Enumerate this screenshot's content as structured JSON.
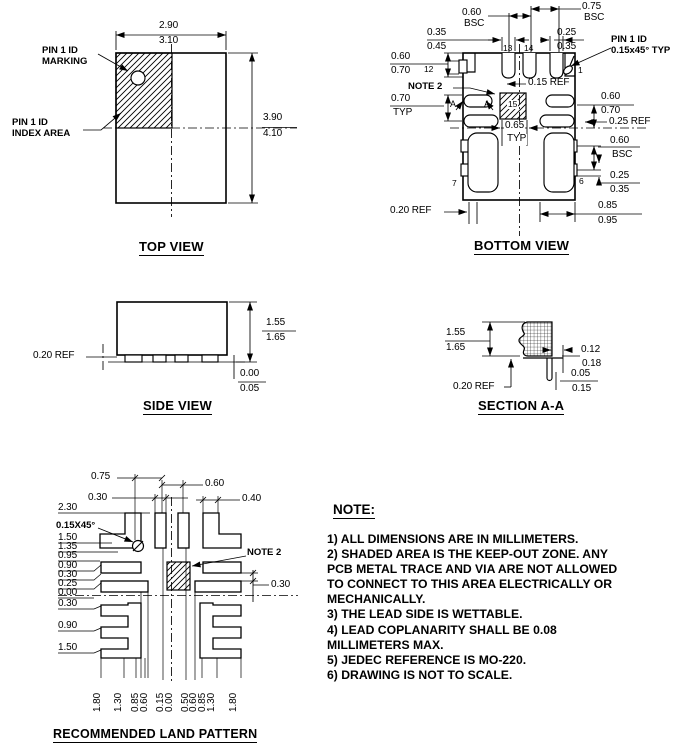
{
  "page": {
    "bg": "#ffffff",
    "ink": "#000000"
  },
  "views": {
    "top_view": {
      "title": "TOP VIEW",
      "labels": [
        {
          "n": "dim-body-width-min",
          "t": "2.90",
          "x": 159,
          "y": 21
        },
        {
          "n": "dim-body-width-max",
          "t": "3.10",
          "x": 159,
          "y": 36
        },
        {
          "n": "dim-body-height-min",
          "t": "3.90",
          "x": 263,
          "y": 113
        },
        {
          "n": "dim-body-height-max",
          "t": "4.10",
          "x": 263,
          "y": 129
        },
        {
          "n": "pin1-marking-label-line1",
          "t": "PIN 1 ID",
          "x": 42,
          "y": 46,
          "b": 1
        },
        {
          "n": "pin1-marking-label-line2",
          "t": "MARKING",
          "x": 42,
          "y": 57,
          "b": 1
        },
        {
          "n": "pin1-index-label-line1",
          "t": "PIN 1 ID",
          "x": 12,
          "y": 118,
          "b": 1
        },
        {
          "n": "pin1-index-label-line2",
          "t": "INDEX AREA",
          "x": 12,
          "y": 129,
          "b": 1
        }
      ]
    },
    "bottom_view": {
      "title": "BOTTOM VIEW",
      "labels": [
        {
          "n": "dim-060-bsc-top-val",
          "t": "0.60",
          "x": 462,
          "y": 8
        },
        {
          "n": "dim-060-bsc-top-unit",
          "t": "BSC",
          "x": 464,
          "y": 19
        },
        {
          "n": "dim-075-bsc-val",
          "t": "0.75",
          "x": 582,
          "y": 2
        },
        {
          "n": "dim-075-bsc-unit",
          "t": "BSC",
          "x": 584,
          "y": 13
        },
        {
          "n": "dim-slot-width-min",
          "t": "0.35",
          "x": 427,
          "y": 28
        },
        {
          "n": "dim-slot-width-max",
          "t": "0.45",
          "x": 427,
          "y": 42
        },
        {
          "n": "dim-pin1-slot-min",
          "t": "0.25",
          "x": 557,
          "y": 28
        },
        {
          "n": "dim-pin1-slot-max",
          "t": "0.35",
          "x": 557,
          "y": 42
        },
        {
          "n": "pin1-id-label-line1",
          "t": "PIN 1 ID",
          "x": 611,
          "y": 35,
          "b": 1
        },
        {
          "n": "pin1-id-label-line2",
          "t": "0.15x45° TYP",
          "x": 611,
          "y": 46,
          "b": 1
        },
        {
          "n": "dim-lead-left-min",
          "t": "0.60",
          "x": 391,
          "y": 52
        },
        {
          "n": "dim-lead-left-max",
          "t": "0.70",
          "x": 391,
          "y": 66
        },
        {
          "n": "pin-12-label",
          "t": "12",
          "x": 424,
          "y": 65,
          "s": 8.5
        },
        {
          "n": "note2-callout",
          "t": "NOTE 2",
          "x": 408,
          "y": 82,
          "b": 1
        },
        {
          "n": "dim-pitch-left-val",
          "t": "0.70",
          "x": 391,
          "y": 94
        },
        {
          "n": "dim-pitch-left-typ",
          "t": "TYP",
          "x": 393,
          "y": 108
        },
        {
          "n": "section-arrow-a-left",
          "t": "A",
          "x": 450,
          "y": 100,
          "s": 9
        },
        {
          "n": "section-arrow-a-right",
          "t": "A",
          "x": 484,
          "y": 100,
          "s": 9
        },
        {
          "n": "dim-015-ref",
          "t": "0.15 REF",
          "x": 528,
          "y": 78
        },
        {
          "n": "pin-13-label",
          "t": "13",
          "x": 503,
          "y": 44,
          "s": 8.5
        },
        {
          "n": "pin-14-label",
          "t": "14",
          "x": 524,
          "y": 44,
          "s": 8.5
        },
        {
          "n": "pin-1-label",
          "t": "1",
          "x": 578,
          "y": 66,
          "s": 8.5
        },
        {
          "n": "pin-15-label",
          "t": "15",
          "x": 507,
          "y": 100,
          "s": 8.5,
          "bg": 1
        },
        {
          "n": "dim-lead-right-min",
          "t": "0.60",
          "x": 601,
          "y": 92
        },
        {
          "n": "dim-lead-right-max",
          "t": "0.70",
          "x": 601,
          "y": 106
        },
        {
          "n": "dim-025-ref-right",
          "t": "0.25 REF",
          "x": 609,
          "y": 117
        },
        {
          "n": "dim-065-typ-val",
          "t": "0.65",
          "x": 504,
          "y": 121,
          "bg": 1
        },
        {
          "n": "dim-065-typ-unit",
          "t": "TYP",
          "x": 506,
          "y": 134,
          "bg": 1
        },
        {
          "n": "dim-060-bsc-right-val",
          "t": "0.60",
          "x": 610,
          "y": 136
        },
        {
          "n": "dim-060-bsc-right-unit",
          "t": "BSC",
          "x": 612,
          "y": 150
        },
        {
          "n": "dim-notch-height-min",
          "t": "0.25",
          "x": 610,
          "y": 171
        },
        {
          "n": "dim-notch-height-max",
          "t": "0.35",
          "x": 610,
          "y": 185
        },
        {
          "n": "dim-corner-pad-min",
          "t": "0.85",
          "x": 598,
          "y": 201
        },
        {
          "n": "dim-corner-pad-max",
          "t": "0.95",
          "x": 598,
          "y": 216
        },
        {
          "n": "pin-7-label",
          "t": "7",
          "x": 452,
          "y": 179,
          "s": 8.5
        },
        {
          "n": "pin-6-label",
          "t": "6",
          "x": 579,
          "y": 177,
          "s": 8.5
        },
        {
          "n": "dim-020-ref-bottom",
          "t": "0.20 REF",
          "x": 390,
          "y": 206
        }
      ]
    },
    "side_view": {
      "title": "SIDE VIEW",
      "labels": [
        {
          "n": "dim-020-ref",
          "t": "0.20 REF",
          "x": 33,
          "y": 351
        },
        {
          "n": "dim-height-min",
          "t": "1.55",
          "x": 266,
          "y": 318
        },
        {
          "n": "dim-height-max",
          "t": "1.65",
          "x": 266,
          "y": 333
        },
        {
          "n": "dim-standoff-min",
          "t": "0.00",
          "x": 240,
          "y": 369
        },
        {
          "n": "dim-standoff-max",
          "t": "0.05",
          "x": 240,
          "y": 384
        }
      ]
    },
    "section_aa": {
      "title": "SECTION A-A",
      "labels": [
        {
          "n": "dim-height-min",
          "t": "1.55",
          "x": 446,
          "y": 328
        },
        {
          "n": "dim-height-max",
          "t": "1.65",
          "x": 446,
          "y": 343
        },
        {
          "n": "dim-flank-min",
          "t": "0.12",
          "x": 581,
          "y": 345
        },
        {
          "n": "dim-flank-max",
          "t": "0.18",
          "x": 582,
          "y": 359
        },
        {
          "n": "dim-step-min",
          "t": "0.05",
          "x": 571,
          "y": 369
        },
        {
          "n": "dim-step-max",
          "t": "0.15",
          "x": 572,
          "y": 384
        },
        {
          "n": "dim-020-ref",
          "t": "0.20 REF",
          "x": 453,
          "y": 382
        }
      ]
    },
    "land_pattern": {
      "title": "RECOMMENDED LAND PATTERN",
      "labels": [
        {
          "n": "dim-075-top",
          "t": "0.75",
          "x": 91,
          "y": 472
        },
        {
          "n": "dim-030-top",
          "t": "0.30",
          "x": 88,
          "y": 493
        },
        {
          "n": "dim-060-top",
          "t": "0.60",
          "x": 205,
          "y": 479
        },
        {
          "n": "dim-040-top",
          "t": "0.40",
          "x": 242,
          "y": 494
        },
        {
          "n": "dim-230-left",
          "t": "2.30",
          "x": 58,
          "y": 503
        },
        {
          "n": "chamfer-callout",
          "t": "0.15X45°",
          "x": 56,
          "y": 521,
          "b": 1
        },
        {
          "n": "dim-150-upper",
          "t": "1.50",
          "x": 58,
          "y": 533
        },
        {
          "n": "dim-135-left",
          "t": "1.35",
          "x": 58,
          "y": 542
        },
        {
          "n": "dim-095-left",
          "t": "0.95",
          "x": 58,
          "y": 551
        },
        {
          "n": "dim-090-upper",
          "t": "0.90",
          "x": 58,
          "y": 561
        },
        {
          "n": "dim-030-upper",
          "t": "0.30",
          "x": 58,
          "y": 570
        },
        {
          "n": "dim-025-left",
          "t": "0.25",
          "x": 58,
          "y": 579
        },
        {
          "n": "dim-000-left",
          "t": "0.00",
          "x": 58,
          "y": 588
        },
        {
          "n": "dim-030-lower",
          "t": "0.30",
          "x": 58,
          "y": 599
        },
        {
          "n": "dim-090-lower",
          "t": "0.90",
          "x": 58,
          "y": 621
        },
        {
          "n": "dim-150-lower",
          "t": "1.50",
          "x": 58,
          "y": 643
        },
        {
          "n": "note2-callout",
          "t": "NOTE 2",
          "x": 247,
          "y": 548,
          "b": 1
        },
        {
          "n": "dim-030-right",
          "t": "0.30",
          "x": 271,
          "y": 580
        },
        {
          "n": "dim-180-bottom-left",
          "t": "1.80",
          "x": 93,
          "y": 712,
          "r": 1
        },
        {
          "n": "dim-130-bottom-left",
          "t": "1.30",
          "x": 114,
          "y": 712,
          "r": 1
        },
        {
          "n": "dim-085-bottom-left",
          "t": "0.85",
          "x": 131,
          "y": 712,
          "r": 1
        },
        {
          "n": "dim-060-bottom-left",
          "t": "0.60",
          "x": 140,
          "y": 712,
          "r": 1
        },
        {
          "n": "dim-015-bottom-left",
          "t": "0.15",
          "x": 156,
          "y": 712,
          "r": 1
        },
        {
          "n": "dim-000-bottom",
          "t": "0.00",
          "x": 165,
          "y": 712,
          "r": 1
        },
        {
          "n": "dim-050-bottom-right",
          "t": "0.50",
          "x": 181,
          "y": 712,
          "r": 1
        },
        {
          "n": "dim-060-bottom-right",
          "t": "0.60",
          "x": 189,
          "y": 712,
          "r": 1
        },
        {
          "n": "dim-085-bottom-right",
          "t": "0.85",
          "x": 198,
          "y": 712,
          "r": 1
        },
        {
          "n": "dim-130-bottom-right",
          "t": "1.30",
          "x": 207,
          "y": 712,
          "r": 1
        },
        {
          "n": "dim-180-bottom-right",
          "t": "1.80",
          "x": 229,
          "y": 712,
          "r": 1
        }
      ]
    }
  },
  "note": {
    "heading": "NOTE:",
    "lines": [
      "1) ALL DIMENSIONS ARE IN MILLIMETERS.",
      "2) SHADED AREA IS THE KEEP-OUT ZONE. ANY",
      "PCB METAL TRACE AND VIA ARE NOT ALLOWED",
      "TO CONNECT TO THIS AREA ELECTRICALLY OR",
      "MECHANICALLY.",
      "3) THE LEAD SIDE IS WETTABLE.",
      "4) LEAD COPLANARITY SHALL BE 0.08",
      "MILLIMETERS MAX.",
      "5) JEDEC REFERENCE IS MO-220.",
      "6) DRAWING IS NOT TO SCALE."
    ]
  }
}
